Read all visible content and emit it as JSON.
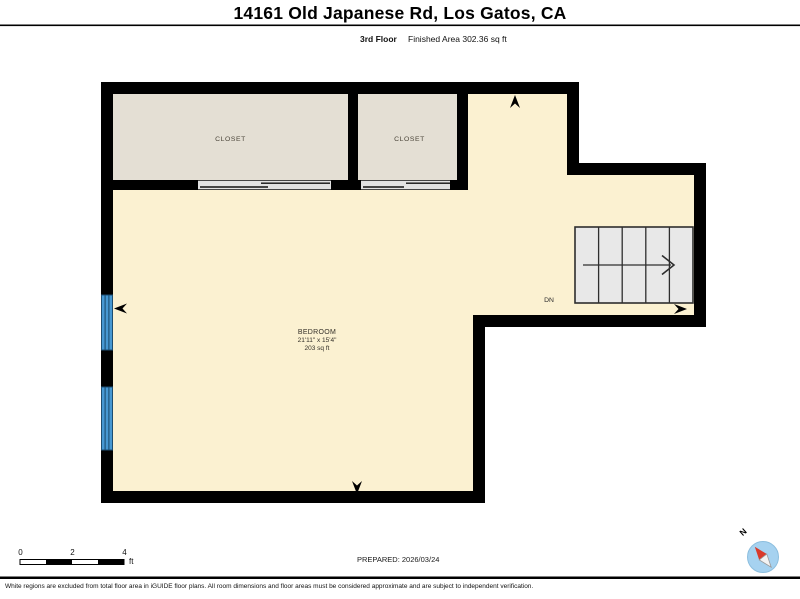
{
  "header": {
    "title": "14161 Old Japanese Rd, Los Gatos, CA",
    "floor_label": "3rd Floor",
    "area_label": "Finished Area 302.36 sq ft"
  },
  "plan": {
    "bedroom": {
      "name": "BEDROOM",
      "dimensions": "21'11\" x 15'4\"",
      "area": "203 sq ft"
    },
    "closet_left_label": "CLOSET",
    "closet_right_label": "CLOSET",
    "stairs_direction": "DN"
  },
  "footer": {
    "scale_ticks": [
      "0",
      "2",
      "4"
    ],
    "scale_unit": "ft",
    "prepared": "PREPARED: 2026/03/24",
    "compass_north": "N",
    "disclaimer": "White regions are excluded from total floor area in iGUIDE floor plans. All room dimensions and floor areas must be considered approximate and are subject to independent verification."
  },
  "colors": {
    "floor": "#fbf1d1",
    "closet_floor": "#e4dfd4",
    "wall": "#000000",
    "stairs_fill": "#e8e8e8",
    "stairs_line": "#2e2e2e",
    "window_blue": "#4798d2",
    "window_stripe": "#1c4d71",
    "door_track_bg": "#e2e2e2",
    "compass_circle": "#a6d2f0",
    "compass_needle_red": "#d93a2b"
  }
}
